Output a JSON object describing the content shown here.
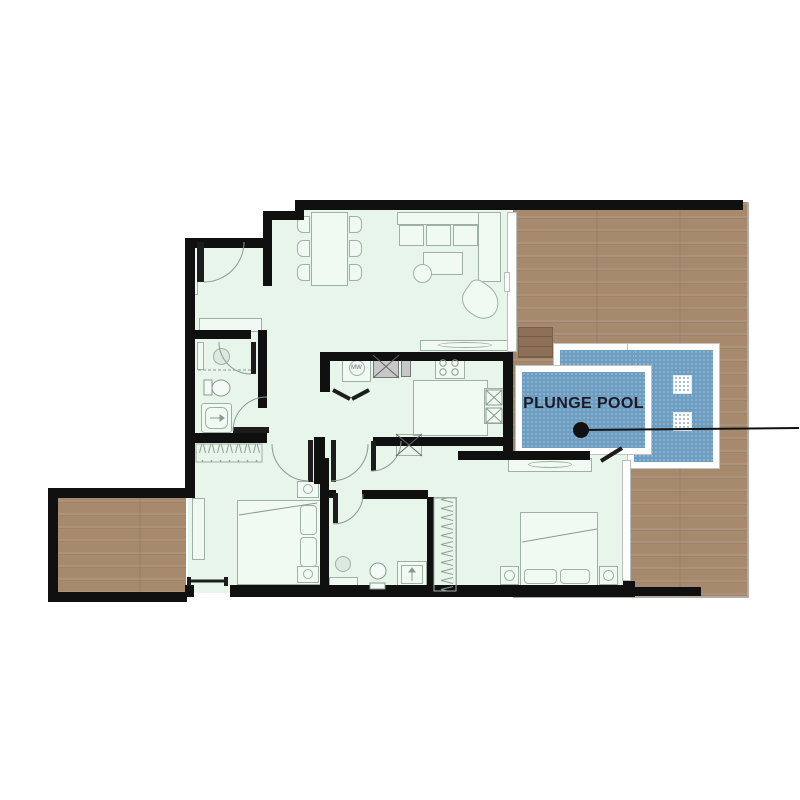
{
  "plan": {
    "pool_label": "PLUNGE POOL",
    "washer_label": "MW"
  },
  "colors": {
    "wall": "#101010",
    "floor_green": "#e8f5ea",
    "furniture_line": "#9fb0a6",
    "furniture_fill": "#f0faf3",
    "wood": "#a78a6e",
    "wood_step": "#8d7057",
    "pool_blue": "#6d9dc0",
    "pool_dot": "#9dbdd4",
    "pool_frame": "#ffffff",
    "pool_edge": "#c2c2c2",
    "label_text": "#1b1b28",
    "leader": "#111111",
    "shaft_gray": "#c8c8c8",
    "glass": "#b7c0ba"
  }
}
